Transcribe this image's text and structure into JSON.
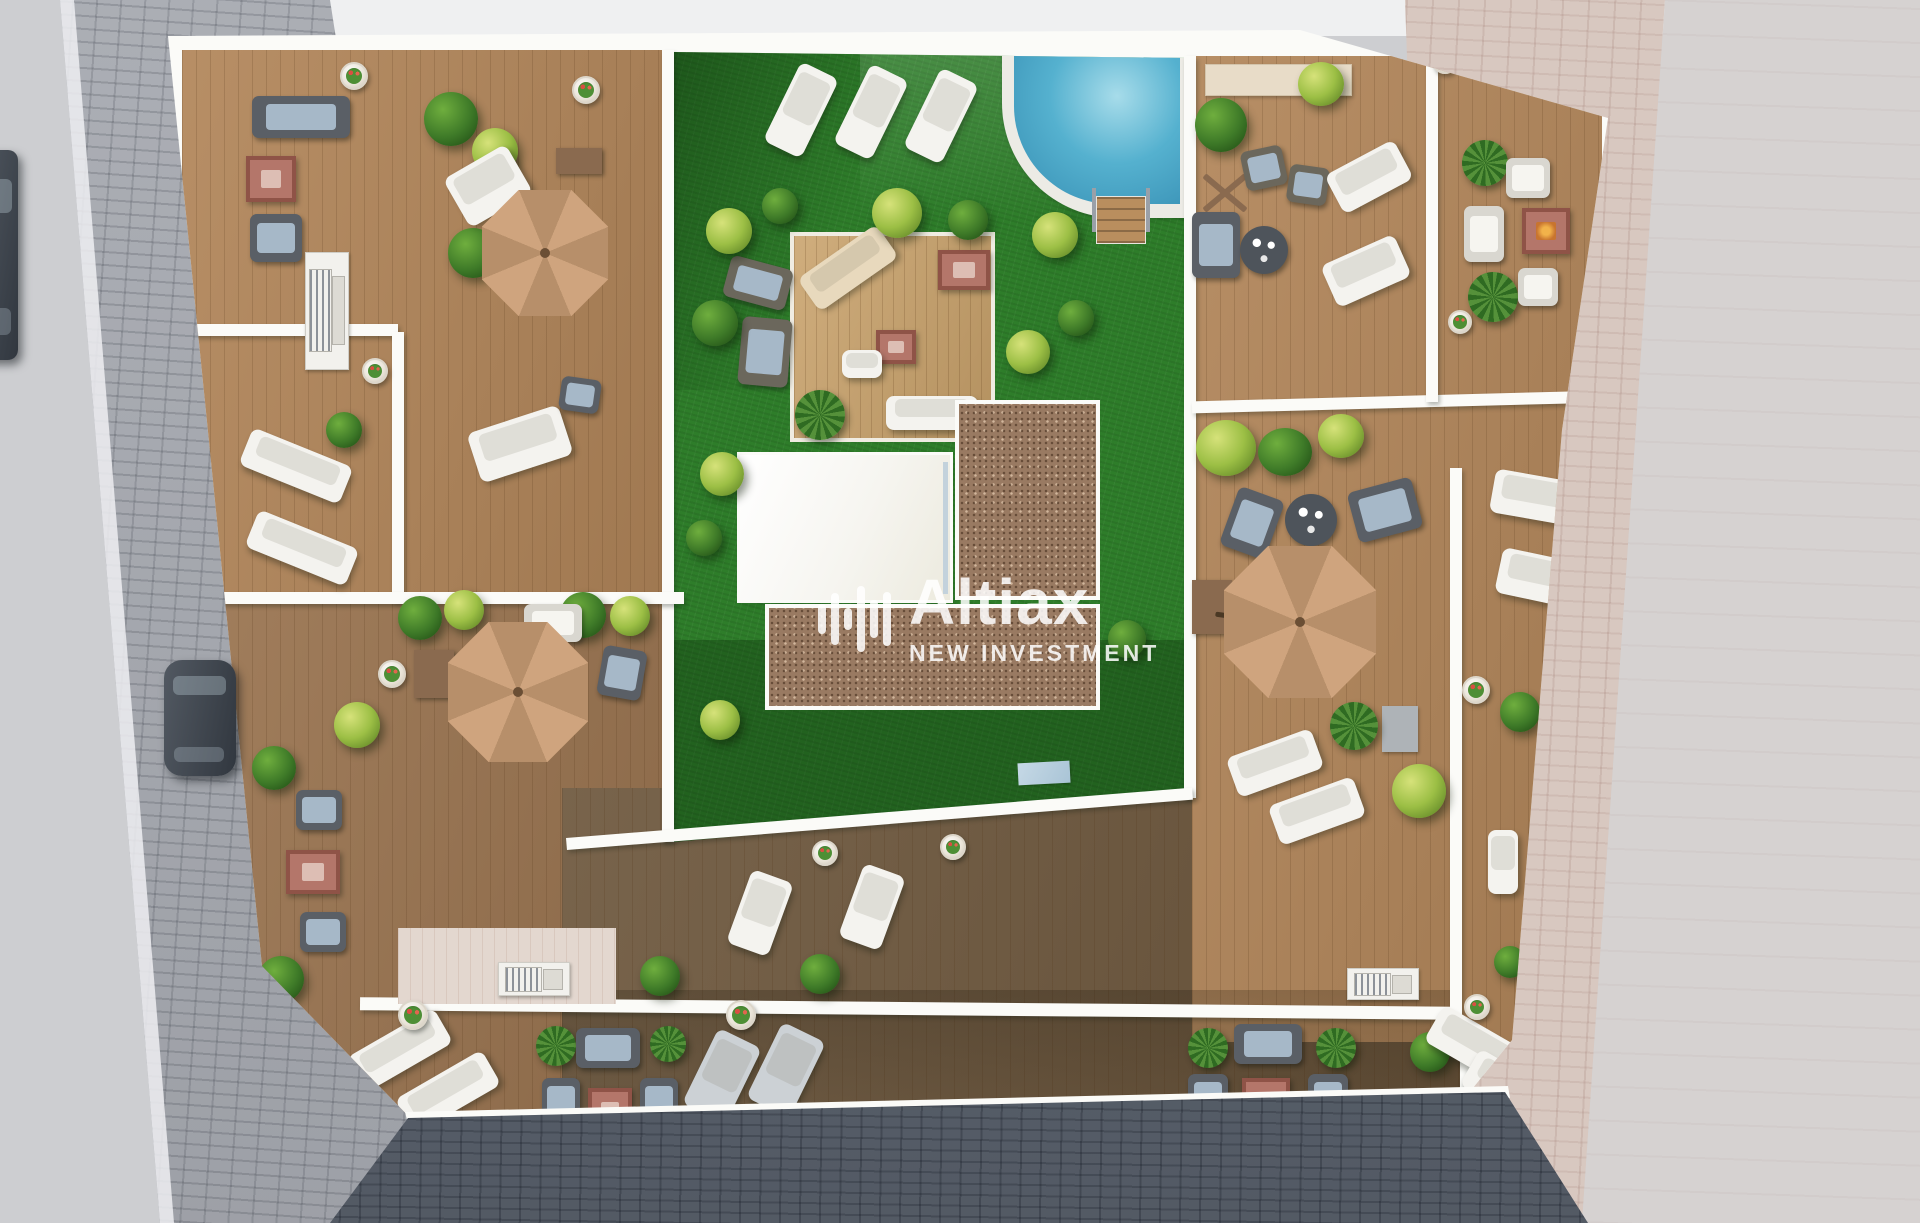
{
  "watermark": {
    "brand": "Altiax",
    "tagline": "NEW INVESTMENT",
    "logo": "equalizer-bars-logo"
  },
  "scene": {
    "title": "Aerial 3D render of a residential rooftop terrace plan",
    "features": {
      "pool": "swimming pool with rounded corner and timber steps",
      "lawn": "central communal artificial lawn",
      "platform": "timber lounge platform with tables and day beds",
      "roof": "white building core roof",
      "gravel": "brown gravel roof sections",
      "terraces": "private wood deck terraces with parasols, sofas and sun loungers",
      "streets": "cobbled sidewalks and dark paved street around the block",
      "vehicles": "parked car at the left kerb"
    },
    "counts": {
      "parasols": 3,
      "sun_loungers_visible": 30,
      "flower_pots": 12
    }
  },
  "colors": {
    "grass": "#2e7d2a",
    "grassShade": "#1c5c1e",
    "pool": "#55b1cf",
    "poolDeep": "#3e97ba",
    "deckLight": "#b2865a",
    "deckMid": "#9a7450",
    "deckDark": "#6e583e",
    "platformWood": "#c9a26b",
    "parasol": "#cfa47e",
    "parasolShade": "#b78f6a",
    "railing": "#fbfbf8",
    "roofWhite": "#f6f5f0",
    "gravel": "#997a62",
    "streetBase": "#cdced1",
    "cobble": "#a6a9b0",
    "streetDark": "#5e6672",
    "roadPink": "#d8c8c0",
    "furnWhite": "#f4f3ef",
    "sofaGray": "#5a5f66",
    "cushionBlue": "#a6b8c8",
    "tableRed": "#b4766a",
    "tableRedFrame": "#8f5347",
    "bushGreen": "#3e7a28",
    "bushLime": "#9cbf45",
    "carGray": "#454c55",
    "watermarkWhite": "rgba(255,255,255,0.86)"
  }
}
